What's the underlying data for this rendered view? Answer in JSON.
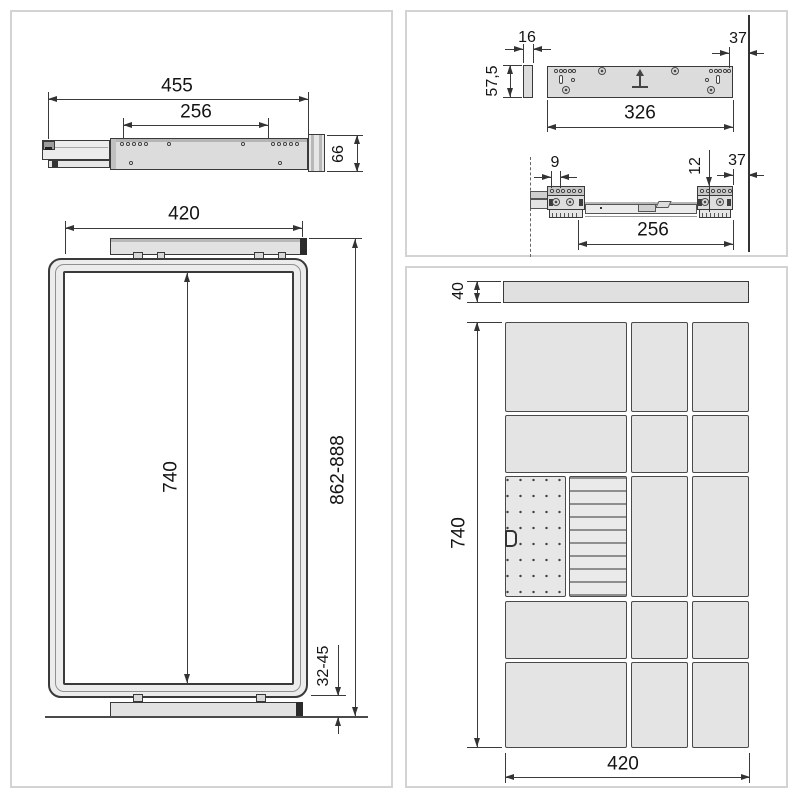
{
  "side_view": {
    "total_length": "455",
    "hole_pitch": "256",
    "end_height": "66"
  },
  "front_view": {
    "top_width": "420",
    "inner_height": "740",
    "overall_height": "862-888",
    "floor_clearance": "32-45"
  },
  "back_plate_view": {
    "thickness": "16",
    "height": "57,5",
    "length": "326",
    "side_clearance": "37"
  },
  "slide_top_view": {
    "front_hole_offset": "9",
    "rear_hole_offset": "12",
    "side_clearance": "37",
    "hole_pitch": "256"
  },
  "panel_front_view": {
    "top_bar_height": "40",
    "panel_height": "740",
    "panel_width": "420"
  },
  "icons": {
    "insertion_direction": "↑",
    "pegboard_hook": "D-hook"
  },
  "colors": {
    "part_fill": "#dcdcdc",
    "panel_cell_fill": "#e4e4e4",
    "drawing_line": "#3a3a3a",
    "panel_border": "#d3d3d3",
    "end_cap": "#2b2b2b"
  }
}
